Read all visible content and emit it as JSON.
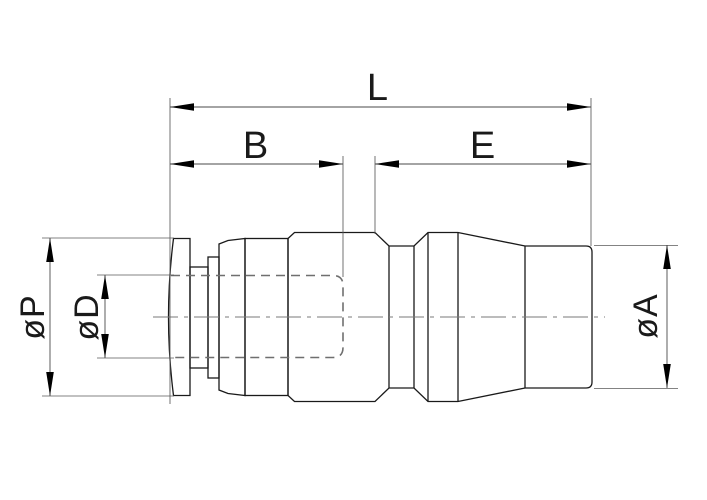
{
  "drawing": {
    "type": "technical-drawing",
    "view": "side-section-view-of-push-in-fitting",
    "labels": {
      "overall_length": "L",
      "left_section_length": "B",
      "right_section_length": "E",
      "collar_diameter": "øP",
      "bore_diameter": "øD",
      "end_diameter": "øA"
    },
    "colors": {
      "background": "#ffffff",
      "outline": "#1a1a1a",
      "dimension_lines": "#4a4a4a",
      "hidden_lines": "#6f6f6f",
      "centerline": "#7a7a7a",
      "arrowheads": "#000000"
    }
  }
}
